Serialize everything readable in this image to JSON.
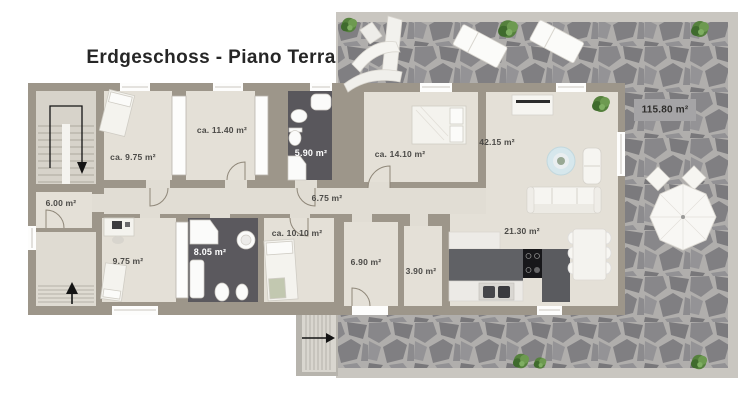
{
  "title": "Erdgeschoss - Piano Terra",
  "floorplan": {
    "terrace": {
      "id": "terrace",
      "type": "terrace",
      "label": "115.80 m²"
    },
    "rooms": [
      {
        "id": "bedroom-top-left",
        "type": "bedroom",
        "label": "ca. 9.75 m²"
      },
      {
        "id": "room-center-top",
        "type": "room",
        "label": "ca. 11.40 m²"
      },
      {
        "id": "bathroom-top",
        "type": "bathroom",
        "label": "5.90 m²"
      },
      {
        "id": "hallway-upper",
        "type": "hallway",
        "label": "6.75 m²"
      },
      {
        "id": "bedroom-right",
        "type": "bedroom",
        "label": "ca. 14.10 m²"
      },
      {
        "id": "living-room",
        "type": "living",
        "label": "42.15 m²"
      },
      {
        "id": "room-left",
        "type": "room",
        "label": "6.00 m²"
      },
      {
        "id": "bedroom-bottom-left",
        "type": "bedroom",
        "label": "9.75 m²"
      },
      {
        "id": "bathroom-bottom",
        "type": "bathroom",
        "label": "8.05 m²"
      },
      {
        "id": "bedroom-bottom-center",
        "type": "bedroom",
        "label": "ca. 10.10 m²"
      },
      {
        "id": "hallway-lower",
        "type": "hallway",
        "label": "6.90 m²"
      },
      {
        "id": "storage-room",
        "type": "room",
        "label": "3.90 m²"
      },
      {
        "id": "kitchen-dining",
        "type": "kitchen",
        "label": "21.30 m²"
      }
    ],
    "icons": {
      "stair_down_arrow": "↓",
      "stair_up_arrow": "↑",
      "entrance_arrow": "→"
    },
    "colors": {
      "wall": "#9d968a",
      "floor": "#e4e0d7",
      "bath_floor": "#59575c",
      "stone": "#8b8a8d",
      "stone_grout": "#b0aeac",
      "terrace_border": "#c9c6c0",
      "rug": "#d6e7ec",
      "counter_dark": "#606165",
      "plant": "#55813d",
      "arrow": "#1a1a1a",
      "label_text": "#4b4a47",
      "label_text_light": "#ffffff"
    }
  }
}
